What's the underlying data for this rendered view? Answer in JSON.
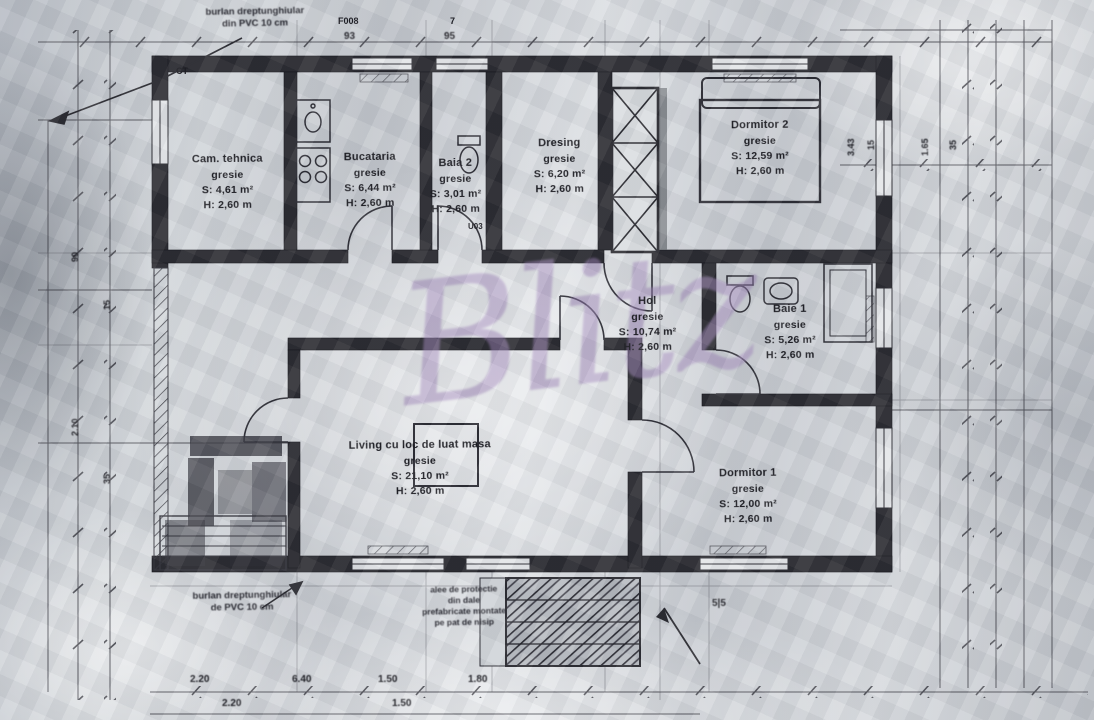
{
  "document": {
    "type": "scanned architectural floor plan",
    "language": "Romanian"
  },
  "watermark": {
    "text": "Blitz",
    "color": "#9d82b8"
  },
  "colors": {
    "ink": "#26262c",
    "paper": "#ccd0d5",
    "watermark_purple": "#9d82b8"
  },
  "rooms": [
    {
      "name": "Cam. tehnica",
      "finish": "gresie",
      "area": "S: 4,61 m²",
      "height": "H: 2,60 m"
    },
    {
      "name": "Bucataria",
      "finish": "gresie",
      "area": "S: 6,44 m²",
      "height": "H: 2,60 m"
    },
    {
      "name": "Baia 2",
      "finish": "gresie",
      "area": "S: 3,01 m²",
      "height": "H: 2,60 m"
    },
    {
      "name": "Dresing",
      "finish": "gresie",
      "area": "S: 6,20 m²",
      "height": "H: 2,60 m"
    },
    {
      "name": "Dormitor 2",
      "finish": "gresie",
      "area": "S: 12,59 m²",
      "height": "H: 2,60 m"
    },
    {
      "name": "Hol",
      "finish": "gresie",
      "area": "S: 10,74 m²",
      "height": "H: 2,60 m"
    },
    {
      "name": "Baie 1",
      "finish": "gresie",
      "area": "S: 5,26 m²",
      "height": "H: 2,60 m"
    },
    {
      "name": "Living cu loc de luat masa",
      "finish": "gresie",
      "area": "S: 21,10 m²",
      "height": "H: 2,60 m"
    },
    {
      "name": "Dormitor 1",
      "finish": "gresie",
      "area": "S: 12,00 m²",
      "height": "H: 2,60 m"
    }
  ],
  "annotations": {
    "top_note_line1": "burlan dreptunghiular",
    "top_note_line2": "din PVC 10 cm",
    "bottom_note_line1": "burlan dreptunghiular",
    "bottom_note_line2": "de PVC 10 cm",
    "steps_note_lines": [
      "alee de protectie",
      "din dale",
      "prefabricate montate",
      "pe pat de nisip"
    ],
    "ct_label": "CT",
    "door_code": "U03",
    "window_code": "F008",
    "window_dim1": "93",
    "window_dim2": "95",
    "window_mark": "7",
    "steps_dim": "5|5"
  },
  "dimensions": {
    "bottom_row1": [
      "2.20",
      "6.40",
      "1.50",
      "1.80"
    ],
    "bottom_row2": [
      "2.20",
      "1.50"
    ],
    "right_rotated": [
      "3.43",
      "15",
      "1.65",
      "35"
    ],
    "left_rotated": [
      "90",
      "15",
      "2.10",
      "35"
    ]
  }
}
